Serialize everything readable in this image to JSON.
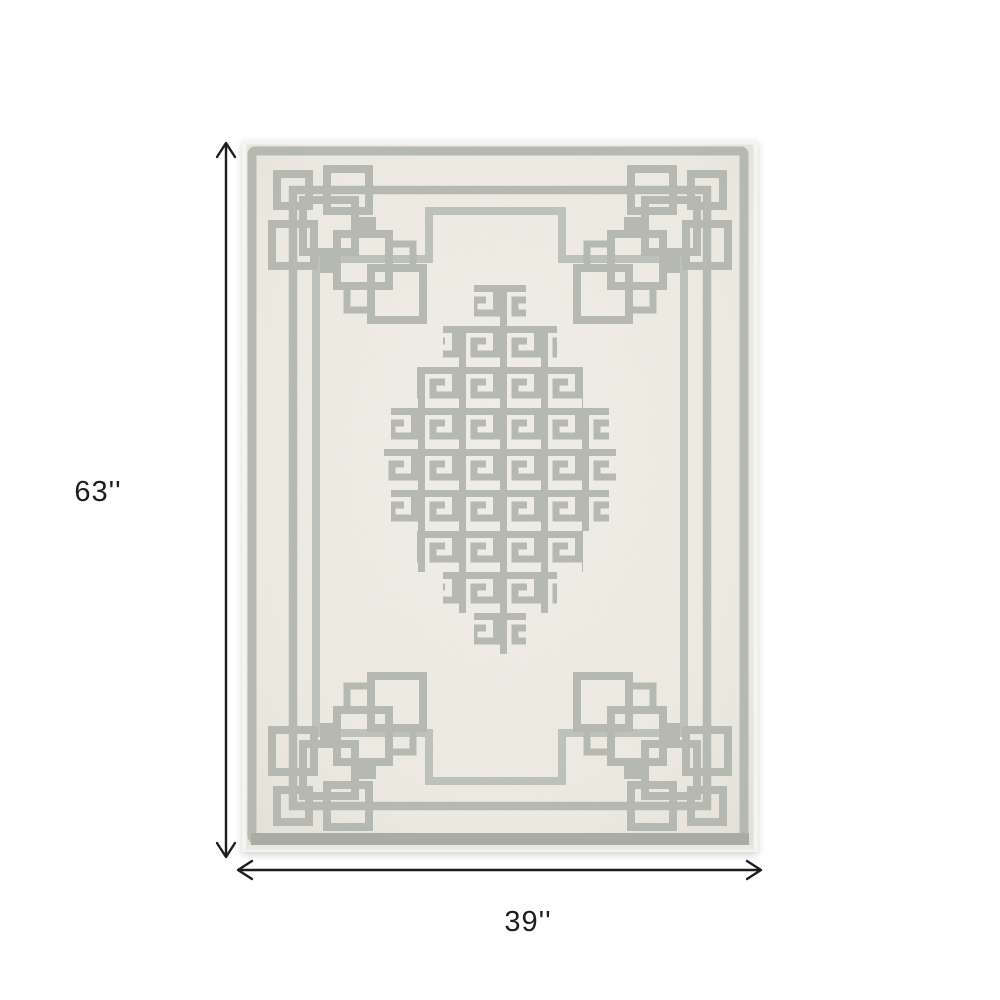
{
  "theme": {
    "page_bg": "#ffffff",
    "annotation_color": "#1d1d1d",
    "rug_field": "#edebe1",
    "rug_field_light": "#f1efe8",
    "rug_field_edge": "#e2e0d5",
    "rug_pattern": "#b6b9b1",
    "rug_pattern_soft": "#bfc2ba",
    "rug_edge_dark": "#a9aca2",
    "rug_pile_edge": "#f7f6f2"
  },
  "annotations": {
    "height": {
      "label": "63''",
      "icon": "vertical-double-arrow"
    },
    "width": {
      "label": "39''",
      "icon": "horizontal-double-arrow"
    }
  },
  "rug": {
    "description": "Ivory and gray Greek key fretwork area rug with corner interlock knots and stepped-diamond center medallion"
  }
}
